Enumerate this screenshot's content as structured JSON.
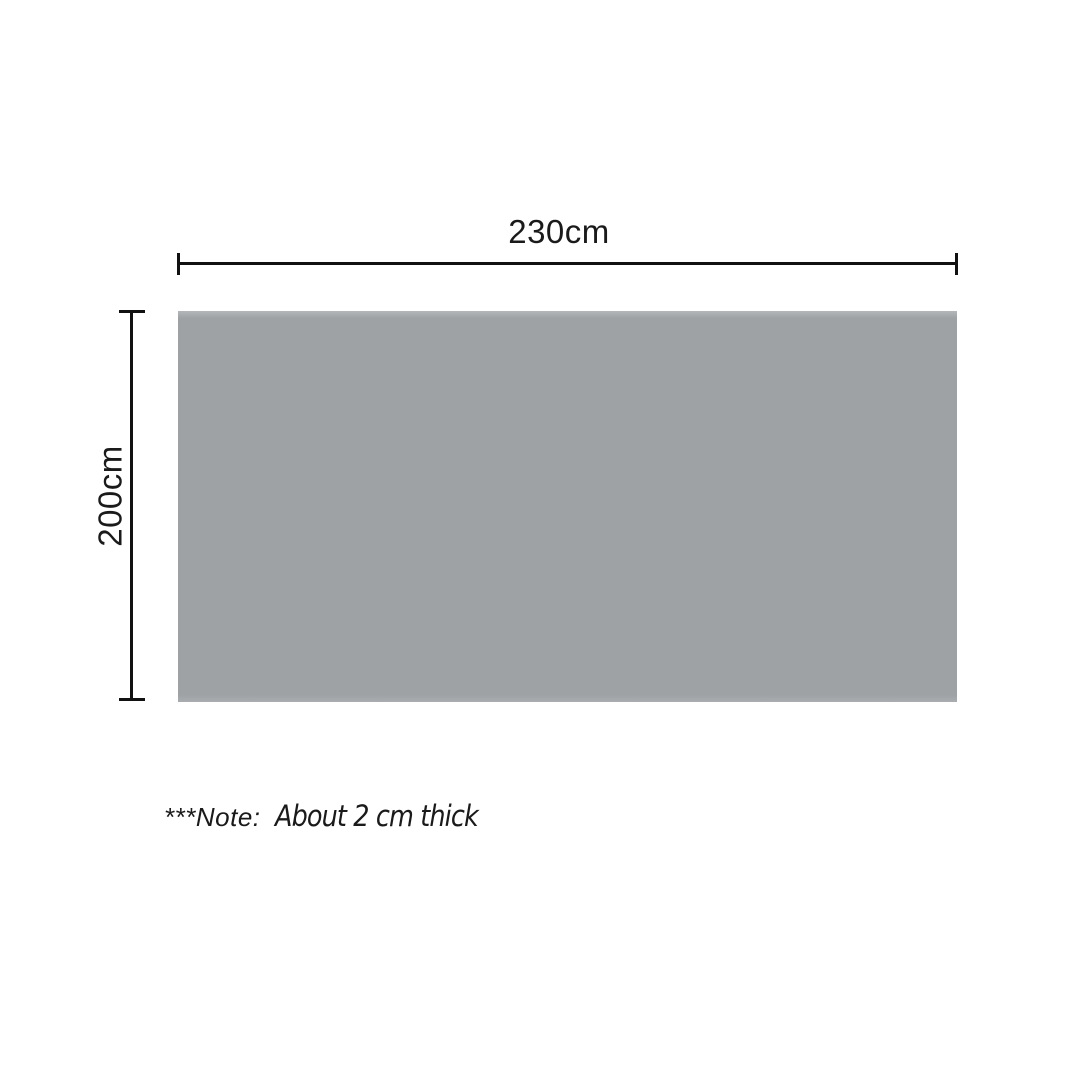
{
  "diagram": {
    "width_label": "230cm",
    "height_label": "200cm",
    "note": {
      "prefix": "***Note:",
      "text": "About 2 cm thick"
    },
    "colors": {
      "rectangle": "#9ea2a5",
      "lines": "#111111",
      "text": "#1a1a1a",
      "background": "#ffffff"
    }
  }
}
